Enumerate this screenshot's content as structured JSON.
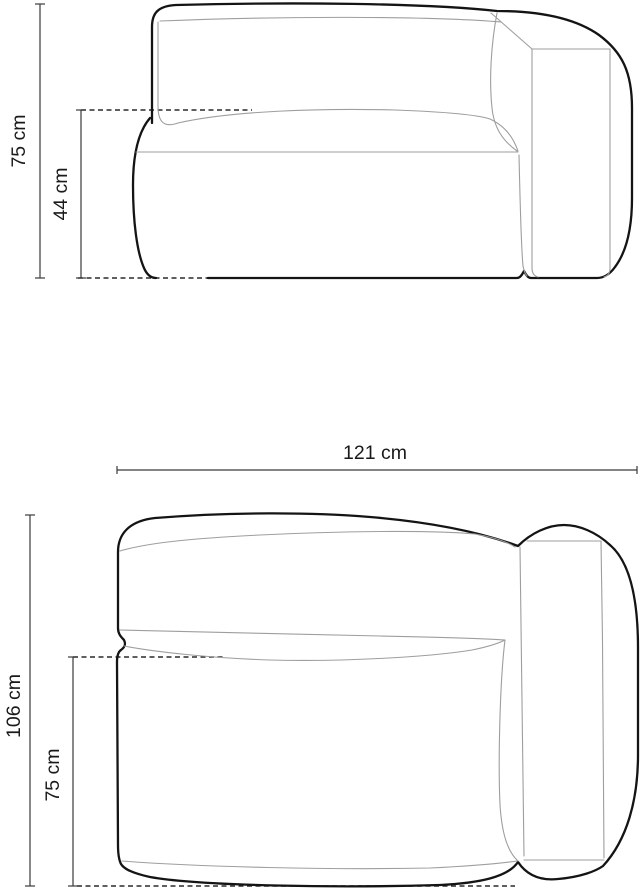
{
  "diagram": {
    "side_view": {
      "overall_height_label": "75 cm",
      "seat_height_label": "44 cm"
    },
    "plan_view": {
      "overall_width_label": "121 cm",
      "overall_depth_label": "106 cm",
      "seat_depth_label": "75 cm"
    },
    "colors": {
      "outline": "#141414",
      "seam": "#9e9e9e",
      "dimension_line": "#3a3a3a",
      "text": "#1a1a1a",
      "background": "#ffffff"
    }
  }
}
